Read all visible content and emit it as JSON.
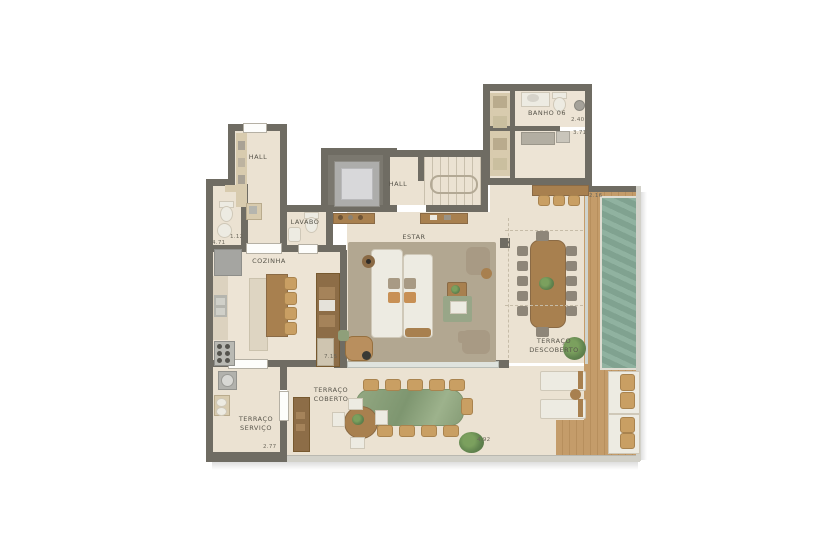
{
  "rooms": {
    "hall_top": {
      "label": "HALL"
    },
    "hall_elev": {
      "label": "HALL"
    },
    "lavabo": {
      "label": "LAVABO"
    },
    "cozinha": {
      "label": "COZINHA"
    },
    "estar": {
      "label": "ESTAR"
    },
    "banho": {
      "label": "BANHO 06"
    },
    "terraco_descoberto": {
      "line1": "TERRAÇO",
      "line2": "DESCOBERTO"
    },
    "terraco_coberto": {
      "line1": "TERRAÇO",
      "line2": "COBERTO"
    },
    "terraco_servico": {
      "line1": "TERRAÇO",
      "line2": "SERVIÇO"
    }
  },
  "dims": {
    "bath_door": "1.12",
    "kitchen_left": "4.71",
    "banho_width": "2.40",
    "banho_lower": "3.71",
    "deck_width": "2.16",
    "servico_width": "2.77",
    "coberto_width": "4.92",
    "kitchen_wall": "7.15"
  },
  "colors": {
    "wall": "#6f6c63",
    "floor": "#ebe2d2",
    "floorLight": "#ede4d5",
    "wood": "#a8804f",
    "woodLight": "#c99f63",
    "deck": "#c49c6a",
    "deckDark": "#b78f5d",
    "pool": "#87ab98",
    "rug": "#b2a791",
    "white": "#edebe2",
    "taupe": "#a89a84",
    "chairGray": "#8e8679",
    "greenTable": "#8ba37c",
    "plant": "#61844f",
    "glass": "#d2d1c9",
    "tan": "#d8cbae",
    "label": "#57544a"
  }
}
